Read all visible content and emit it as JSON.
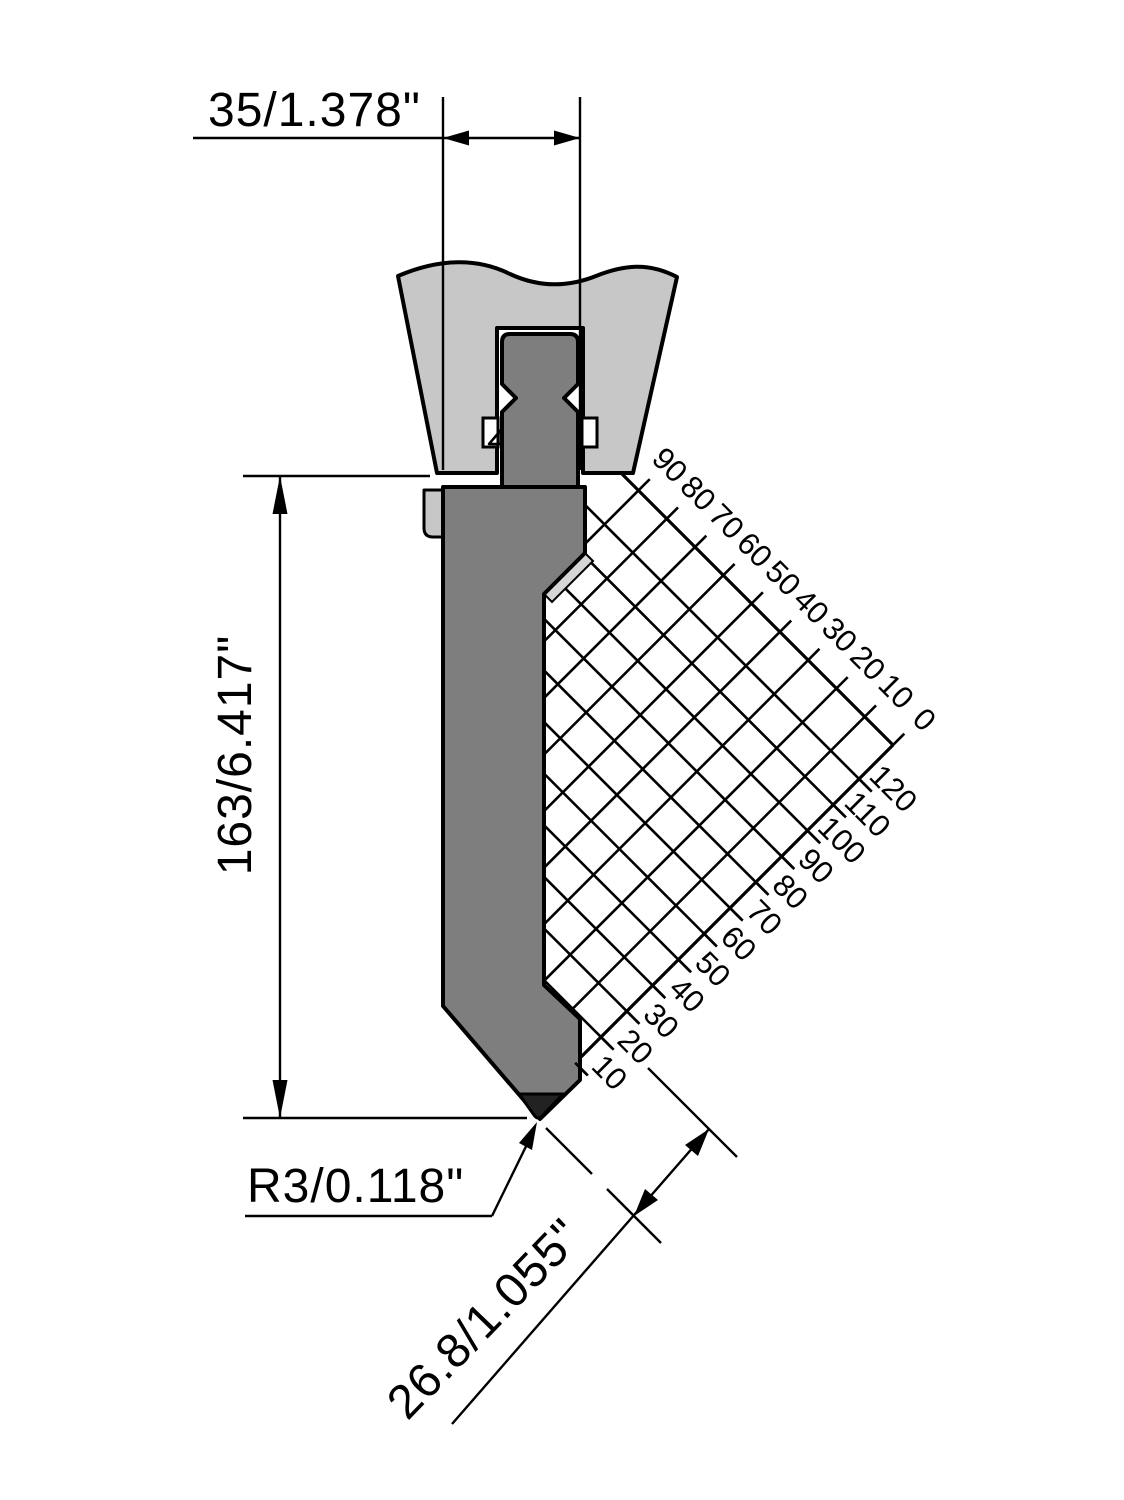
{
  "drawing": {
    "title": "press-brake-punch-technical-drawing",
    "dimensions": {
      "width": "35/1.378\"",
      "height": "163/6.417\"",
      "radius": "R3/0.118\"",
      "working_height": "26.8/1.055\""
    },
    "angle_scale": {
      "top_labels": [
        "90",
        "80",
        "70",
        "60",
        "50",
        "40",
        "30",
        "20",
        "10",
        "0"
      ],
      "side_labels": [
        "120",
        "110",
        "100",
        "90",
        "80",
        "70",
        "60",
        "50",
        "40",
        "30",
        "20",
        "10"
      ]
    },
    "colors": {
      "background": "#ffffff",
      "clamp": "#c7c7c7",
      "punch": "#7e7e7e",
      "chamfer_highlight": "#d6d6d6",
      "tip": "#222222",
      "line": "#000000"
    }
  }
}
